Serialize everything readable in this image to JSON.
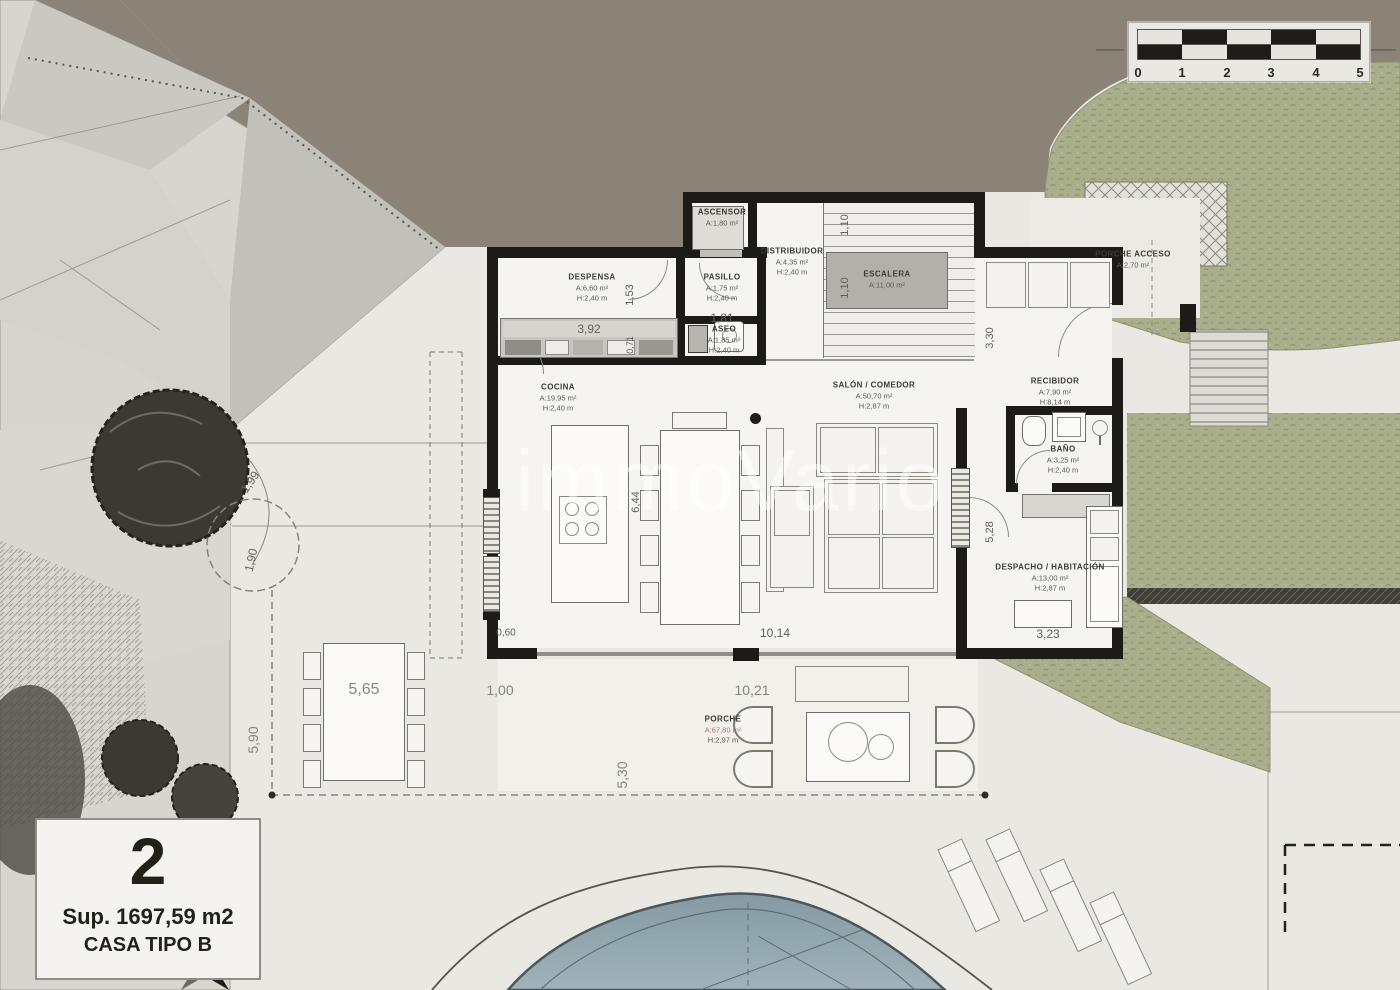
{
  "watermark": "immoVario",
  "title_box": {
    "plot_number": "2",
    "surface": "Sup. 1697,59 m2",
    "house_type": "CASA TIPO B"
  },
  "scale_bar": {
    "ticks": [
      "0",
      "1",
      "2",
      "3",
      "4",
      "5"
    ]
  },
  "rooms": [
    {
      "id": "ascensor",
      "name": "ASCENSOR",
      "area": "A:1,80 m²",
      "height": ""
    },
    {
      "id": "distribuidor",
      "name": "DISTRIBUIDOR",
      "area": "A:4,35 m²",
      "height": "H:2,40 m"
    },
    {
      "id": "escalera",
      "name": "ESCALERA",
      "area": "A:11,00 m²",
      "height": ""
    },
    {
      "id": "despensa",
      "name": "DESPENSA",
      "area": "A:6,60 m²",
      "height": "H:2,40 m"
    },
    {
      "id": "pasillo",
      "name": "PASILLO",
      "area": "A:1,75 m²",
      "height": "H:2,40 m"
    },
    {
      "id": "aseo",
      "name": "ASEO",
      "area": "A:1,85 m²",
      "height": "H:2,40 m"
    },
    {
      "id": "cocina",
      "name": "COCINA",
      "area": "A:19,95 m²",
      "height": "H:2,40 m"
    },
    {
      "id": "salon",
      "name": "SALÓN / COMEDOR",
      "area": "A:50,70 m²",
      "height": "H:2,87 m"
    },
    {
      "id": "recibidor",
      "name": "RECIBIDOR",
      "area": "A:7,90 m²",
      "height": "H:8,14 m"
    },
    {
      "id": "bano",
      "name": "BAÑO",
      "area": "A:3,25 m²",
      "height": "H:2,40 m"
    },
    {
      "id": "despacho",
      "name": "DESPACHO / HABITACIÓN",
      "area": "A:13,00 m²",
      "height": "H:2,87 m"
    },
    {
      "id": "porche",
      "name": "PORCHE",
      "area": "A:67,80 m²",
      "height": "H:2,97 m"
    },
    {
      "id": "porche_acceso",
      "name": "PORCHE ACCESO",
      "area": "A:2,70 m²",
      "height": ""
    }
  ],
  "dims": {
    "despensa_cabinets": "3,92",
    "aseo_width": "1,81",
    "despensa_side": "1,53",
    "aseo_side": "0,71",
    "stair_flight_upper": "1,10",
    "stair_flight_lower": "1,10",
    "recibidor_side": "3,30",
    "despacho_side": "5,28",
    "cocina_length": "6,44",
    "salon_width": "10,14",
    "despacho_width": "3,23",
    "wall_segment": "0,60",
    "porch_offset": "1,00",
    "porch_width": "10,21",
    "outdoor_table": "5,65",
    "terrace_side": "5,90",
    "porch_depth": "5,30",
    "slope_upper": "1,99",
    "slope_lower": "1,90"
  },
  "colors": {
    "dark_band": "#8b8377",
    "vegetation": "#a9ae8b",
    "pool": "#92a8b1",
    "porch_area_text": "#b5736b"
  }
}
